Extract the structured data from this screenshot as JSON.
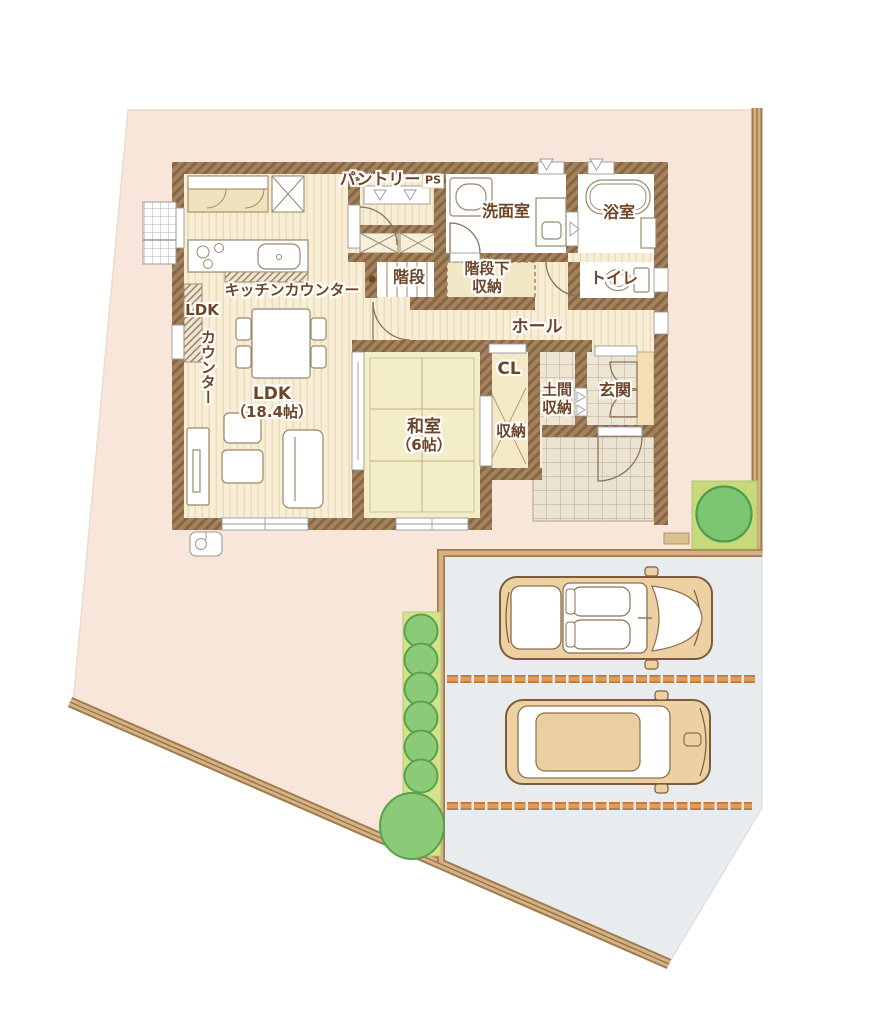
{
  "title": "1F floor plan with parking",
  "rooms": {
    "pantry": "パントリー",
    "ps": "PS",
    "washroom": "洗面室",
    "bathroom": "浴室",
    "kitchen_counter": "キッチンカウンター",
    "stairs": "階段",
    "under_stairs_line1": "階段下",
    "under_stairs_line2": "収納",
    "toilet": "トイレ",
    "ldk_counter_line1": "LDK",
    "ldk_counter_line2": "カウンター",
    "hall": "ホール",
    "ldk_line1": "LDK",
    "ldk_line2": "（18.4帖）",
    "closet": "CL",
    "japanese_room_line1": "和室",
    "japanese_room_line2": "（6帖）",
    "doma_line1": "土間",
    "doma_line2": "収納",
    "entrance": "玄関",
    "storage": "収納"
  },
  "areas": {
    "ldk_size_jo": 18.4,
    "japanese_room_size_jo": 6
  },
  "colors": {
    "lot_fill": "#f9e6da",
    "boundary_tan": "#d2b284",
    "boundary_dark": "#a07c4c",
    "parking_fill": "#e9ecef",
    "brick_line": "#d78f4f",
    "wall_brown": "#8b6a46",
    "wood_floor": "#f7eed5",
    "tatami": "#f4edca",
    "tile": "#eee6d5",
    "hedge": "#d6e18c",
    "bush_green": "#8bcb78",
    "tree_green": "#7cc671",
    "car_body": "#edd1a3",
    "label_text": "#6f4527"
  }
}
